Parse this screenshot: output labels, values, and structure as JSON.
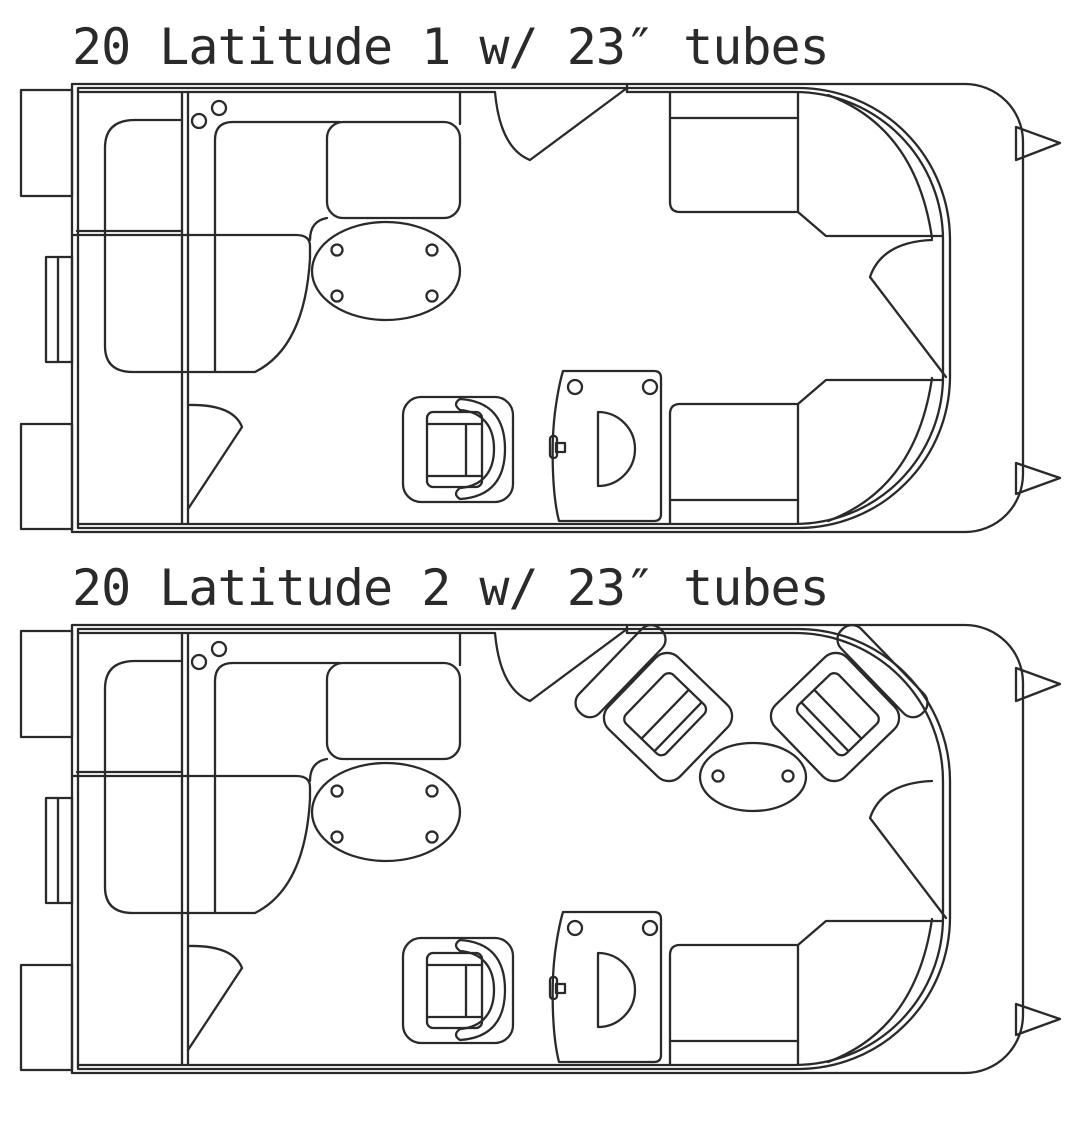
{
  "colors": {
    "background": "#ffffff",
    "ink": "#2a2a2a"
  },
  "boats": [
    {
      "id": "boat-1",
      "title": "20 Latitude 1 w/ 23″ tubes",
      "components": [
        "stern-platform",
        "outboard-motor",
        "port-stern-lounge",
        "dinette-table",
        "cup-holders",
        "captain-chair",
        "helm-console",
        "steering-wheel",
        "throttle-lever",
        "stern-side-gate",
        "midship-gate",
        "bow-gate",
        "port-bow-lounge",
        "starboard-bow-lounge",
        "bow-fence",
        "pontoon-nose-cones"
      ]
    },
    {
      "id": "boat-2",
      "title": "20 Latitude 2 w/ 23″ tubes",
      "components": [
        "stern-platform",
        "outboard-motor",
        "port-stern-lounge",
        "dinette-table",
        "cup-holders",
        "captain-chair",
        "helm-console",
        "steering-wheel",
        "throttle-lever",
        "stern-side-gate",
        "midship-gate",
        "bow-gate",
        "swivel-chair-port",
        "swivel-chair-starboard",
        "cocktail-table",
        "starboard-bow-lounge",
        "bow-fence",
        "pontoon-nose-cones"
      ]
    }
  ]
}
